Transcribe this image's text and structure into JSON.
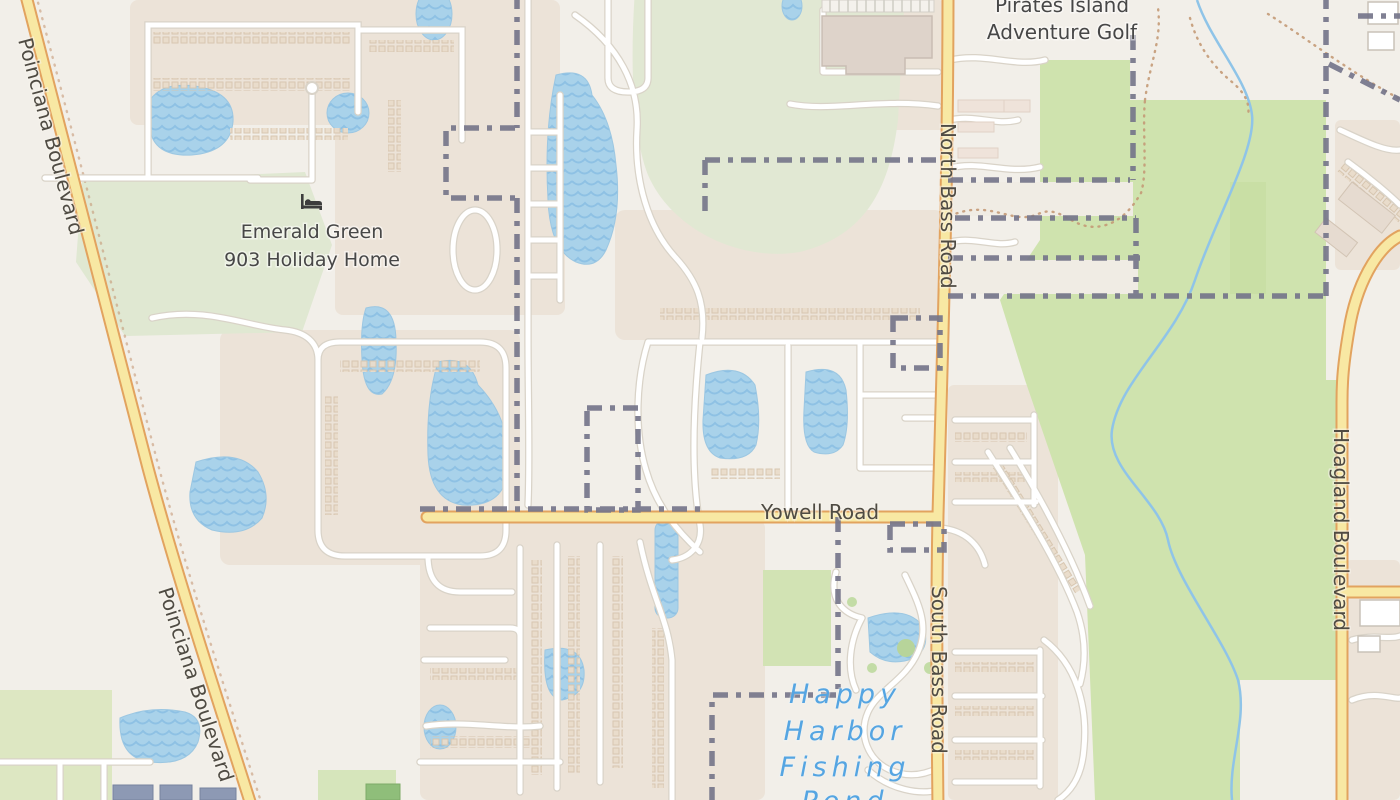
{
  "map": {
    "labels": {
      "pirates_island": {
        "line1": "Pirates Island",
        "line2": "Adventure Golf"
      },
      "emerald_green": {
        "line1": "Emerald Green",
        "line2": "903 Holiday Home"
      },
      "happy_harbor": {
        "line1": "Happy",
        "line2": "Harbor",
        "line3": "Fishing",
        "line4": "Pond"
      },
      "roads": {
        "poinciana_1": "Poinciana Boulevard",
        "poinciana_2": "Poinciana Boulevard",
        "north_bass": "North Bass Road",
        "south_bass": "South Bass Road",
        "yowell": "Yowell Road",
        "hoagland": "Hoagland Boulevard"
      }
    },
    "icons": {
      "lodging": "bed-icon"
    },
    "colors": {
      "land": "#f2efe9",
      "residential": "#ece3d8",
      "green_muted": "#e1e8d3",
      "green_bright": "#cfe3ae",
      "water": "#a9d2ea",
      "water_wave": "#8ec1e4",
      "road_major_fill": "#f8e8a3",
      "road_major_casing": "#e2a35f",
      "road_minor_fill": "#ffffff",
      "road_minor_casing": "#d9d3c8",
      "boundary": "#76768a",
      "stream": "#8fc4e8",
      "trail": "#c49a76",
      "label_dark": "#4a4a4a",
      "label_water": "#55a5e2"
    }
  }
}
